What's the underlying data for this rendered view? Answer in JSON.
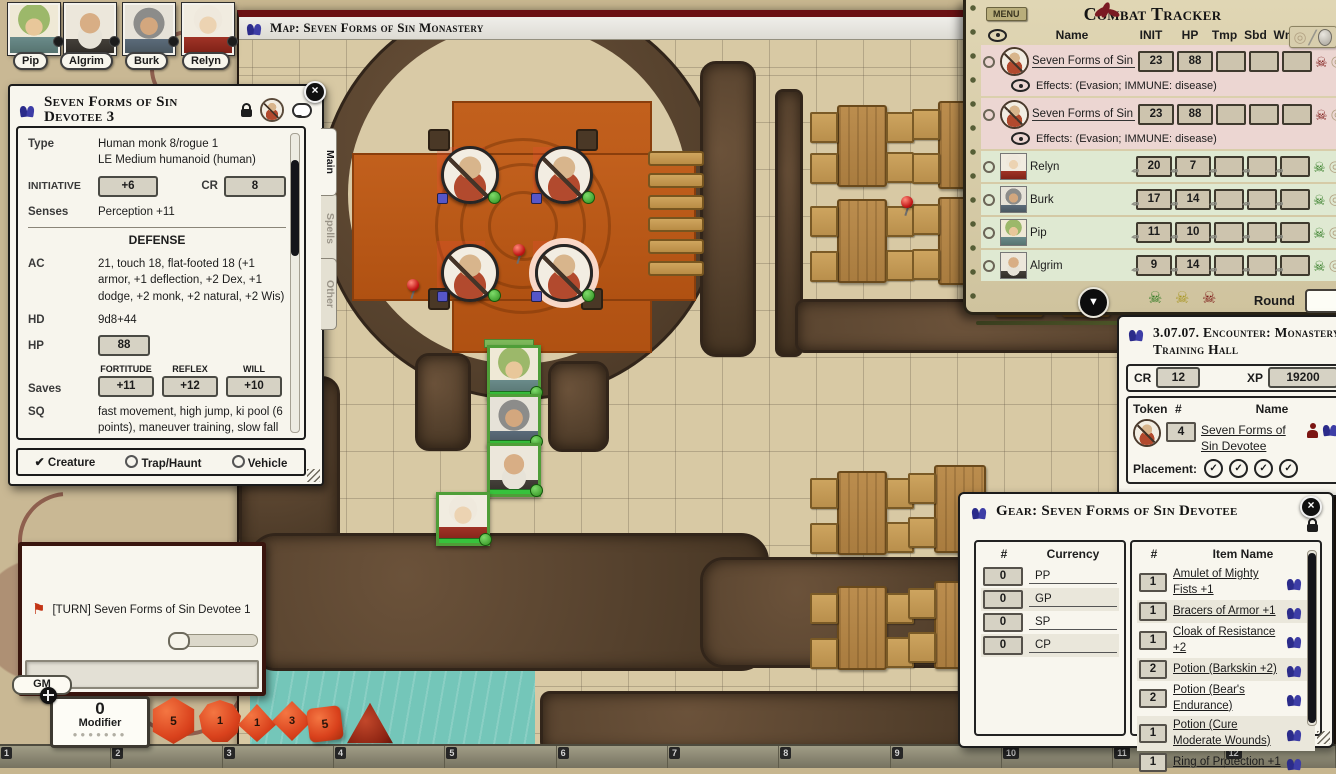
{
  "colors": {
    "accent_blue": "#2b2b8a",
    "npc_row": "#ecd6d2",
    "pc_row": "#dfe9d2",
    "platform_orange": "#b85415",
    "water_teal": "#74c6b9",
    "skull_red": "#7c1614",
    "skull_green": "#2f7a21",
    "die_orange": "#d9411c"
  },
  "icons": {
    "skull": "☠",
    "reticle": "◎",
    "sword": "╱",
    "down_arrow": "▼",
    "close": "×",
    "check": "✔",
    "check_circle": "✓",
    "flag": "⚑",
    "pencil": "✎"
  },
  "portraits": [
    {
      "name": "Pip"
    },
    {
      "name": "Algrim"
    },
    {
      "name": "Burk"
    },
    {
      "name": "Relyn"
    }
  ],
  "map": {
    "title": "Map: Seven Forms of Sin Monastery"
  },
  "sheet": {
    "title": "Seven Forms of Sin Devotee 3",
    "tabs": {
      "main": "Main",
      "spells": "Spells",
      "other": "Other"
    },
    "type_label": "Type",
    "type_line1": "Human monk 8/rogue 1",
    "type_line2": "LE Medium humanoid (human)",
    "init_label": "INITIATIVE",
    "init_value": "+6",
    "cr_label": "CR",
    "cr_value": "8",
    "senses_label": "Senses",
    "senses_value": "Perception +11",
    "defense_header": "DEFENSE",
    "ac_label": "AC",
    "ac_value": "21, touch 18, flat-footed 18 (+1 armor, +1 deflection, +2 Dex, +1 dodge, +2 monk, +2 natural, +2 Wis)",
    "hd_label": "HD",
    "hd_value": "9d8+44",
    "hp_label": "HP",
    "hp_value": "88",
    "saves_label": "Saves",
    "fort_label": "FORTITUDE",
    "fort_value": "+11",
    "reflex_label": "REFLEX",
    "reflex_value": "+12",
    "will_label": "WILL",
    "will_value": "+10",
    "sq_label": "SQ",
    "sq_value": "fast movement, high jump, ki pool (6 points), maneuver training, slow fall 40 ft., trapfinding +1, wholeness of body (8 hit points), evasion, +2 saves vs. enchantments; Immune disease",
    "offense_header": "OFFENSE",
    "creature_option": "Creature",
    "trap_option": "Trap/Haunt",
    "vehicle_option": "Vehicle"
  },
  "tracker": {
    "menu": "MENU",
    "title": "Combat Tracker",
    "col_name": "Name",
    "col_init": "INIT",
    "col_hp": "HP",
    "col_tmp": "Tmp",
    "col_sbd": "Sbd",
    "col_wnd": "Wnd",
    "rows": [
      {
        "name": "Seven Forms of Sin Devote",
        "init": "23",
        "hp": "88",
        "effects": "Effects: (Evasion; IMMUNE: disease)"
      },
      {
        "name": "Seven Forms of Sin Devote",
        "init": "23",
        "hp": "88",
        "effects": "Effects: (Evasion; IMMUNE: disease)"
      },
      {
        "name": "Relyn",
        "init": "20",
        "hp": "7"
      },
      {
        "name": "Burk",
        "init": "17",
        "hp": "14"
      },
      {
        "name": "Pip",
        "init": "11",
        "hp": "10"
      },
      {
        "name": "Algrim",
        "init": "9",
        "hp": "14"
      }
    ],
    "round_label": "Round"
  },
  "encounter": {
    "title": "3.07.07. Encounter: Monastery Training Hall",
    "cr_label": "CR",
    "cr_value": "12",
    "xp_label": "XP",
    "xp_value": "19200",
    "col_token": "Token",
    "col_qty": "#",
    "col_name": "Name",
    "row": {
      "qty": "4",
      "name": "Seven Forms of Sin Devotee"
    },
    "placement_label": "Placement:"
  },
  "gear": {
    "title": "Gear: Seven Forms of Sin Devotee",
    "col_qty": "#",
    "col_currency": "Currency",
    "col_item_qty": "#",
    "col_item_name": "Item Name",
    "currency": [
      {
        "qty": "0",
        "code": "PP"
      },
      {
        "qty": "0",
        "code": "GP"
      },
      {
        "qty": "0",
        "code": "SP"
      },
      {
        "qty": "0",
        "code": "CP"
      }
    ],
    "items": [
      {
        "qty": "1",
        "name": "Amulet of Mighty Fists +1"
      },
      {
        "qty": "1",
        "name": "Bracers of Armor +1"
      },
      {
        "qty": "1",
        "name": "Cloak of Resistance +2"
      },
      {
        "qty": "2",
        "name": "Potion (Barkskin +2)"
      },
      {
        "qty": "2",
        "name": "Potion (Bear's Endurance)"
      },
      {
        "qty": "1",
        "name": "Potion (Cure Moderate Wounds)"
      },
      {
        "qty": "1",
        "name": "Ring of Protection +1"
      }
    ]
  },
  "chat": {
    "turn_message": "[TURN] Seven Forms of Sin Devotee 1",
    "gm_label": "GM"
  },
  "modifier": {
    "value": "0",
    "label": "Modifier"
  },
  "hotbar": {
    "slots": [
      "1",
      "2",
      "3",
      "4",
      "5",
      "6",
      "7",
      "8",
      "9",
      "10",
      "11",
      "12"
    ]
  },
  "dice": {
    "d20_face": "5",
    "d12_face": "1",
    "d10_face": "1",
    "d8_face": "3",
    "d6_face": "5"
  }
}
